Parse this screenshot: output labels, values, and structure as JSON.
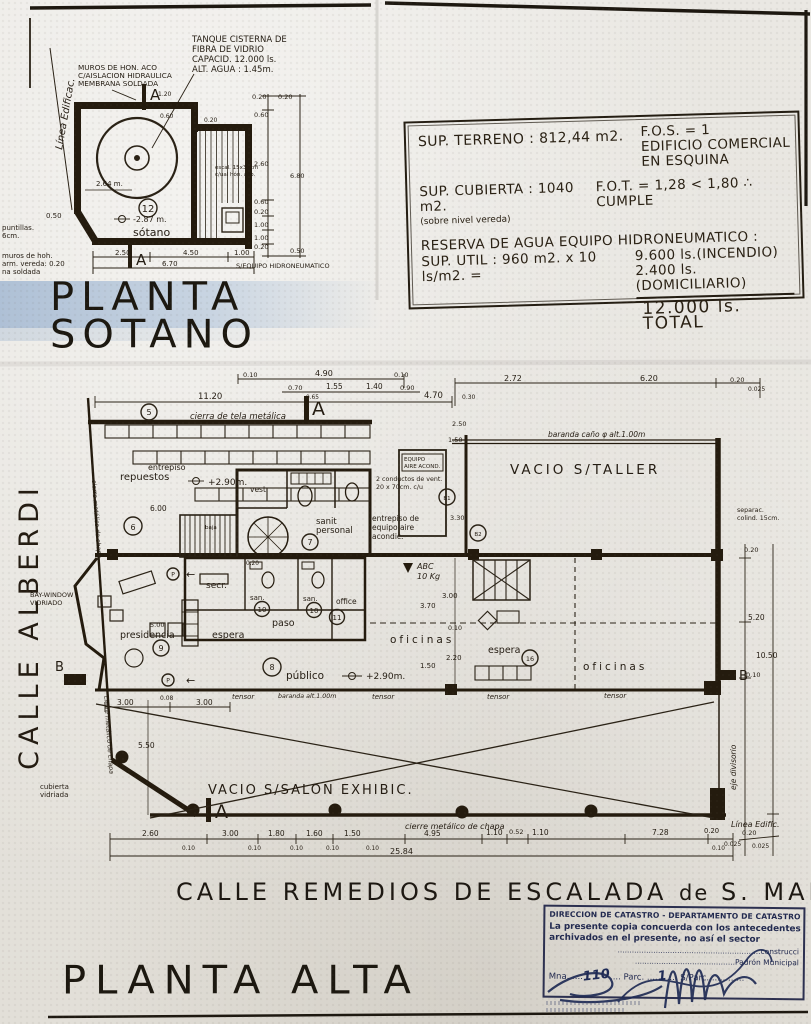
{
  "sotano": {
    "title1": "PLANTA",
    "title2": "SOTANO",
    "linea_edif": "Línea Edificac.",
    "tank1": "TANQUE CISTERNA DE",
    "tank2": "FIBRA DE VIDRIO",
    "tank3": "CAPACID. 12.000 ls.",
    "tank4": "ALT. AGUA : 1.45m.",
    "muros1": "MUROS DE HON. ACO",
    "muros2": "C/AISLACION HIDRAULICA",
    "muros3": "MEMBRANA SOLDADA",
    "left1a": "puntillas.",
    "left1b": "6cm.",
    "left2a": "muros de hoh.",
    "left2b": "arm. vereda: 0.20",
    "left2c": "na soldada",
    "stair1": "escal. 15x30cm",
    "stair2": "c/ual hón. aco.",
    "equip": "S/EQUIPO HIDRONEUMATICO",
    "room": "sótano",
    "num": "12",
    "level": "-2.87 m.",
    "dim_int": "2.64 m.",
    "a": "A",
    "dims_r": [
      "0.20",
      "0.20",
      "0.60",
      "2.60",
      "6.80",
      "0.60",
      "0.20",
      "1.00",
      "1.00",
      "0.20",
      "0.50"
    ],
    "dims_b": [
      "2.50",
      "4.50",
      "1.00",
      "6.70",
      "0.50"
    ],
    "dims_t": [
      "1.20",
      "0.60",
      "0.20"
    ]
  },
  "infobox": {
    "l1a": "SUP. TERRENO : 812,44 m2.",
    "l1b": "F.O.S. = 1",
    "l1c": "EDIFICIO COMERCIAL",
    "l1d": "EN ESQUINA",
    "l2a": "SUP. CUBIERTA : 1040 m2.",
    "l2sub": "(sobre nivel vereda)",
    "l2b": "F.O.T. = 1,28 < 1,80 ∴ CUMPLE",
    "l3": "RESERVA DE AGUA EQUIPO HIDRONEUMATICO :",
    "l4a": "SUP. UTIL : 960 m2. x 10 ls/m2. =",
    "l4b": "9.600 ls.(INCENDIO)",
    "l5": "2.400 ls.(DOMICILIARIO)",
    "l6": "12.000 ls. TOTAL"
  },
  "alta": {
    "calle_alberdi": "CALLE ALBERDI",
    "street1": "CALLE  REMEDIOS  DE  ESCALADA",
    "street2": "de",
    "street3": "S. MARTIN",
    "title": "PLANTA ALTA",
    "cierra": "cierra de tela metálica",
    "entrepiso": "entrepiso",
    "repuestos": "repuestos",
    "nivel": "+2.90m.",
    "baranda": "baranda caño φ alt.1.00m",
    "equipo_box1": "EQUIPO",
    "equipo_box2": "AIRE ACOND.",
    "conductos1": "2 conductos de vent.",
    "conductos2": "20 x 70cm. c/u",
    "vacio_taller": "VACIO S/TALLER",
    "separac1": "separac.",
    "separac2": "colind. 15cm.",
    "vest": "vest.",
    "sanit1": "sanit",
    "sanit2": "personal",
    "entq1": "entrepiso de",
    "entq2": "equipo aire",
    "entq3": "acondic.",
    "secr": "secr.",
    "san": "san.",
    "office": "office",
    "paso": "paso",
    "espera": "espera",
    "presidencia": "presidencia",
    "bay1": "BAY-WINDOW",
    "bay2": "VIDRIADO",
    "publico": "público",
    "oficinas": "oficinas",
    "tensor": "tensor",
    "baranda2": "baranda alt.1.00m",
    "abc1": "ABC",
    "abc2": "10 Kg",
    "vacio_salon": "VACIO S/SALON EXHIBIC.",
    "cub1": "cubierta",
    "cub2": "vidriada",
    "chapa": "cierre metálico de chapa",
    "linea": "Línea Edific.",
    "eje": "eje divisorio",
    "cierre_vert": "cierre metálico de chapa",
    "a": "A",
    "b": "B",
    "baja": "baja",
    "p": "P",
    "c5": "5",
    "c6": "6",
    "c7": "7",
    "c8": "8",
    "c9": "9",
    "c10": "10",
    "c11": "11",
    "c16": "16",
    "b1": "B1",
    "b2": "B2",
    "dims_top": [
      "0.10",
      "4.90",
      "0.10",
      "0.70",
      "1.55",
      "1.40",
      "0.90",
      "0.65",
      "11.20",
      "4.70",
      "2.72",
      "6.20",
      "0.20",
      "0.025",
      "0.30"
    ],
    "dims_left": [
      "3.00",
      "0.08",
      "3.00",
      "5.50",
      "5.00"
    ],
    "dims_right": [
      "0.20",
      "5.20",
      "10.50",
      "0.10",
      "0.20",
      "0.025"
    ],
    "dims_inner": [
      "6.00",
      "2.50",
      "1.50",
      "3.30",
      "3.70",
      "3.00",
      "0.10",
      "2.20",
      "1.50",
      "0.20"
    ],
    "dims_bottom": [
      "2.60",
      "3.00",
      "1.80",
      "1.60",
      "1.50",
      "4.95",
      "1.10",
      "0.52",
      "1.10",
      "7.28",
      "0.20",
      "0.025"
    ],
    "sub_dim": "0.10",
    "total": "25.84"
  },
  "stamp": {
    "l1": "DIRECCION DE CATASTRO - DEPARTAMENTO DE CATASTRO FÍSICO",
    "l2": "La presente copia concuerda con los antecedentes",
    "l3": "archivados en el presente, no así el sector",
    "dots1": "............................................................construcci",
    "dots2": "..........................................Padrón Municipal",
    "mna": "Mna.",
    "mna_v": "110",
    "parc": "Parc.",
    "parc_v": "1",
    "sparc": "S/Parc.",
    "dots3": "............"
  }
}
